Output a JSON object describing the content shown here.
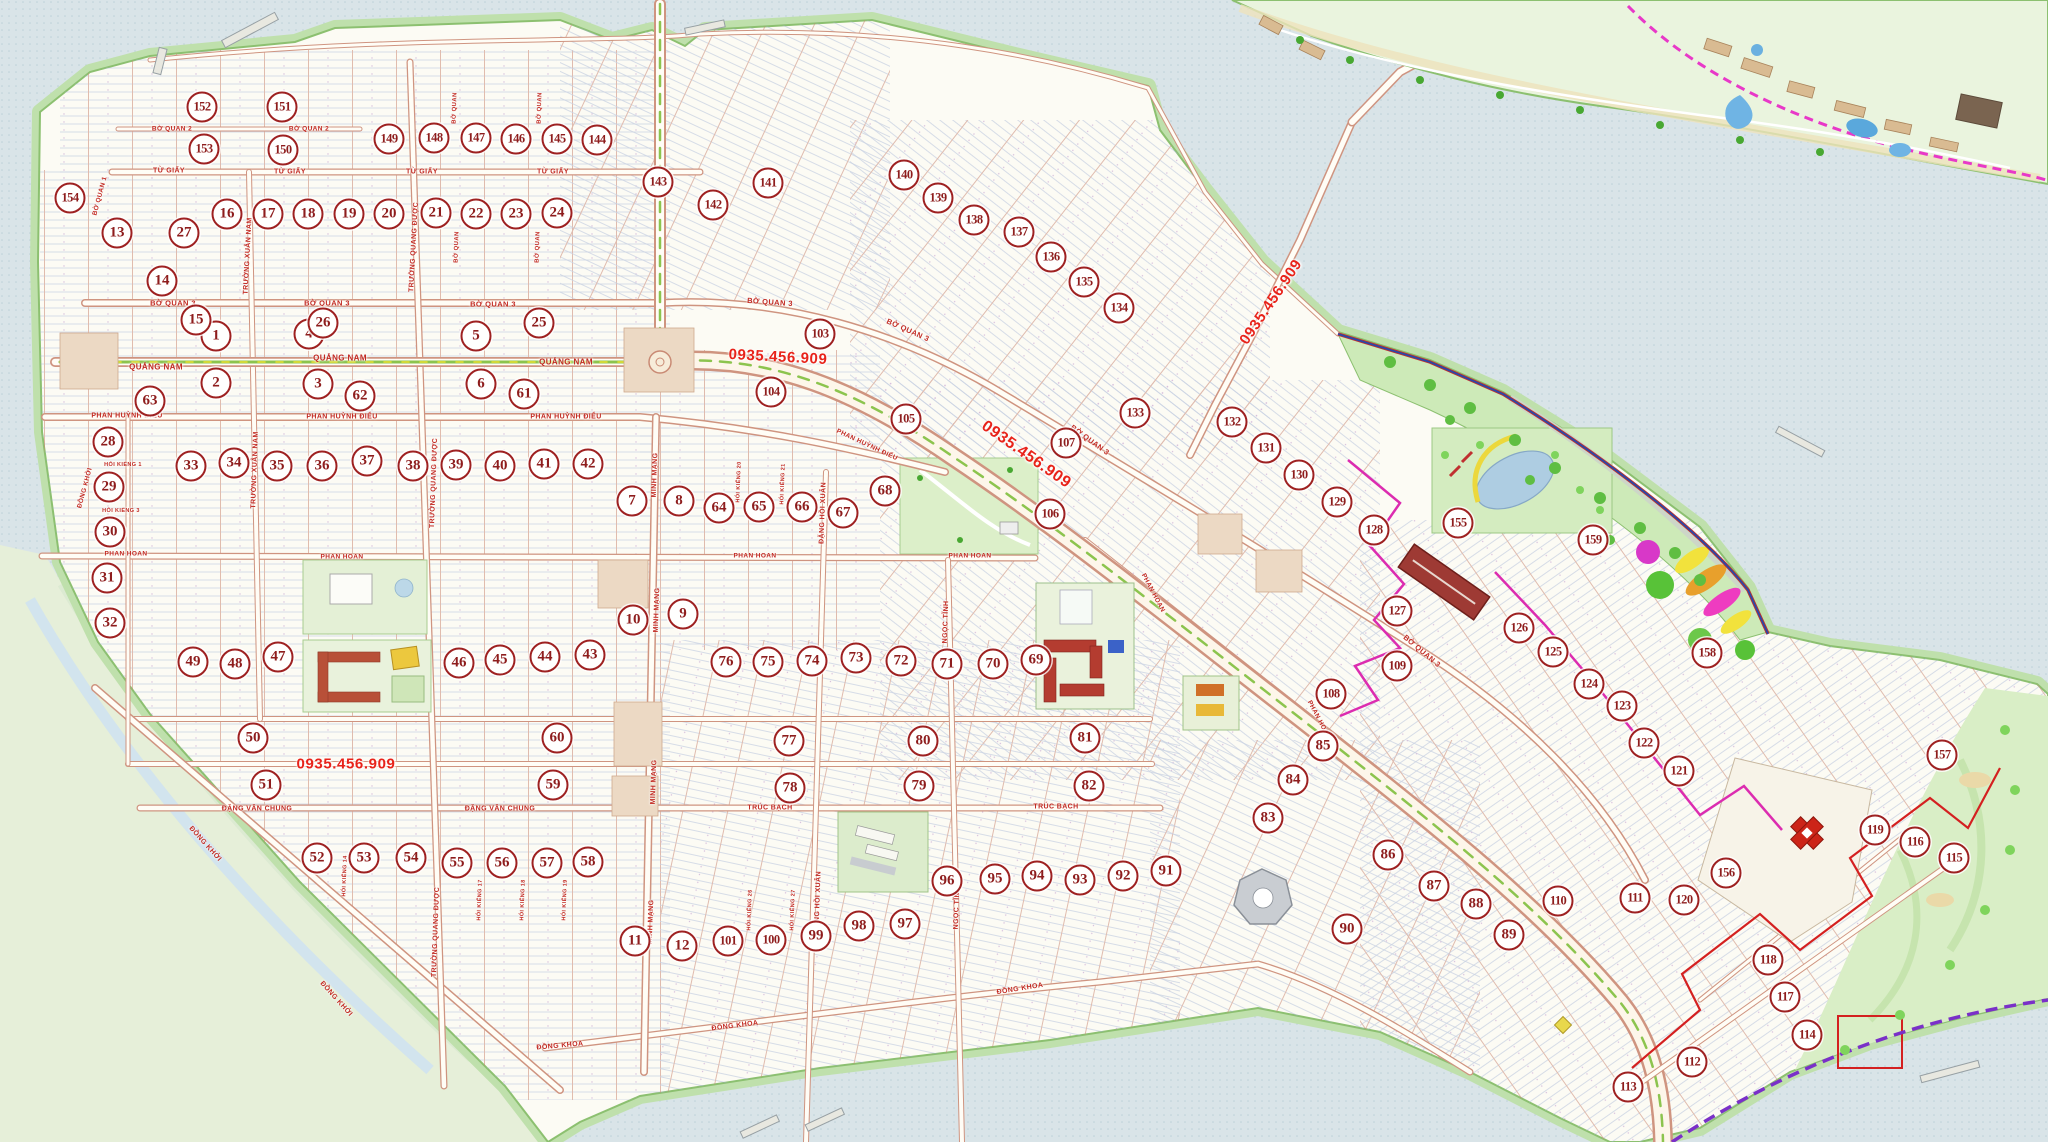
{
  "map_type": "real-estate subdivision master plan",
  "phone_number": "0935.456.909",
  "phone_labels": [
    {
      "text": "0935.456.909",
      "x": 778,
      "y": 357,
      "rot": 3,
      "size": 15
    },
    {
      "text": "0935.456.909",
      "x": 1026,
      "y": 455,
      "rot": 35,
      "size": 16
    },
    {
      "text": "0935.456.909",
      "x": 1271,
      "y": 302,
      "rot": -56,
      "size": 15
    },
    {
      "text": "0935.456.909",
      "x": 346,
      "y": 764,
      "rot": 0,
      "size": 15
    }
  ],
  "street_labels": [
    [
      "TỪ GIẤY",
      169,
      171,
      0,
      7
    ],
    [
      "TỪ GIẤY",
      290,
      172,
      0,
      7
    ],
    [
      "TỪ GIẤY",
      422,
      172,
      0,
      7
    ],
    [
      "TỪ GIẤY",
      553,
      172,
      0,
      7
    ],
    [
      "BỜ QUAN 2",
      172,
      129,
      0,
      6.5
    ],
    [
      "BỜ QUAN 2",
      309,
      129,
      0,
      6.5
    ],
    [
      "BỜ QUAN 1",
      100,
      196,
      -75,
      6.5
    ],
    [
      "BỜ QUAN",
      455,
      108,
      -88,
      6
    ],
    [
      "BỜ QUAN",
      540,
      108,
      -88,
      6
    ],
    [
      "BỜ QUAN",
      457,
      247,
      -88,
      6
    ],
    [
      "BỜ QUAN",
      538,
      247,
      -88,
      6
    ],
    [
      "BỜ QUAN 3",
      173,
      303,
      0,
      7.5
    ],
    [
      "BỜ QUAN 3",
      327,
      303,
      0,
      7.5
    ],
    [
      "BỜ QUAN 3",
      493,
      304,
      0,
      7.5
    ],
    [
      "BỜ QUAN 3",
      770,
      302,
      4,
      7.5
    ],
    [
      "BỜ QUAN 3",
      908,
      330,
      24,
      7.5
    ],
    [
      "BỜ QUAN 3",
      1090,
      440,
      36,
      7.5
    ],
    [
      "BỜ QUAN 3",
      1422,
      651,
      40,
      7.5
    ],
    [
      "QUẢNG NAM",
      156,
      367,
      0,
      8
    ],
    [
      "QUẢNG NAM",
      340,
      358,
      0,
      8
    ],
    [
      "QUẢNG NAM",
      566,
      362,
      0,
      8
    ],
    [
      "PHAN HUỲNH ĐIỂU",
      127,
      416,
      0,
      7
    ],
    [
      "PHAN HUỲNH ĐIỂU",
      342,
      417,
      0,
      7
    ],
    [
      "PHAN HUỲNH ĐIỂU",
      566,
      417,
      0,
      7
    ],
    [
      "PHAN HUỲNH ĐIỂU",
      867,
      445,
      25,
      6.5
    ],
    [
      "PHAN HOAN",
      126,
      554,
      0,
      6.5
    ],
    [
      "PHAN HOAN",
      342,
      557,
      0,
      6.5
    ],
    [
      "PHAN HOAN",
      755,
      556,
      0,
      6.5
    ],
    [
      "PHAN HOAN",
      970,
      556,
      0,
      6.5
    ],
    [
      "PHAN HOAN",
      1153,
      593,
      62,
      6.5
    ],
    [
      "PHAN HOAN",
      1319,
      720,
      62,
      6.5
    ],
    [
      "TRÚC BẠCH",
      770,
      808,
      0,
      7
    ],
    [
      "TRÚC BẠCH",
      1056,
      807,
      0,
      7
    ],
    [
      "ĐẶNG VĂN CHUNG",
      257,
      809,
      0,
      7
    ],
    [
      "ĐẶNG VĂN CHUNG",
      500,
      809,
      0,
      7
    ],
    [
      "ĐỒNG KHOA",
      560,
      1046,
      -5,
      7
    ],
    [
      "ĐỒNG KHOA",
      735,
      1026,
      -7,
      7
    ],
    [
      "ĐỒNG KHOA",
      1020,
      989,
      -9,
      7
    ],
    [
      "ĐỒNG KHỞI",
      205,
      844,
      48,
      7
    ],
    [
      "ĐỒNG KHỞI",
      336,
      999,
      48,
      7
    ],
    [
      "ĐỒNG KHỞI",
      85,
      488,
      -75,
      6.5
    ],
    [
      "MINH MẠNG",
      655,
      475,
      -88,
      7
    ],
    [
      "MINH MẠNG",
      657,
      610,
      -88,
      7
    ],
    [
      "MINH MẠNG",
      654,
      782,
      -88,
      7
    ],
    [
      "MINH MẠNG",
      651,
      922,
      -88,
      7
    ],
    [
      "TRƯỜNG XUÂN NAM",
      248,
      256,
      -87,
      7
    ],
    [
      "TRƯỜNG XUÂN NAM",
      255,
      470,
      -88,
      7
    ],
    [
      "TRƯỜNG QUANG ĐƯỢC",
      414,
      247,
      -87,
      7
    ],
    [
      "TRƯỜNG QUANG ĐƯỢC",
      434,
      483,
      -88,
      7
    ],
    [
      "TRƯỜNG QUANG ĐƯỢC",
      436,
      932,
      -88,
      7
    ],
    [
      "ĐẶNG HỒI XUÂN",
      823,
      513,
      -88,
      7
    ],
    [
      "ĐẶNG HỒI XUÂN",
      818,
      902,
      -88,
      7
    ],
    [
      "NGỌC TĨNH",
      946,
      622,
      -88,
      7
    ],
    [
      "NGỌC TĨNH",
      957,
      908,
      -88,
      7
    ],
    [
      "HÓI KIỂNG 1",
      123,
      465,
      0,
      5.5
    ],
    [
      "HÓI KIỂNG 3",
      121,
      511,
      0,
      5.5
    ],
    [
      "HÓI KIỂNG 20",
      739,
      482,
      -88,
      5.5
    ],
    [
      "HÓI KIỂNG 21",
      783,
      484,
      -88,
      5.5
    ],
    [
      "HÓI KIỂNG 14",
      345,
      876,
      -88,
      5.5
    ],
    [
      "HÓI KIỂNG 17",
      480,
      900,
      -88,
      5.5
    ],
    [
      "HÓI KIỂNG 18",
      523,
      900,
      -88,
      5.5
    ],
    [
      "HÓI KIỂNG 19",
      565,
      900,
      -88,
      5.5
    ],
    [
      "HÓI KIỂNG 26",
      750,
      910,
      -88,
      5.5
    ],
    [
      "HÓI KIỂNG 27",
      793,
      910,
      -88,
      5.5
    ]
  ],
  "blocks": [
    [
      1,
      216,
      336
    ],
    [
      2,
      216,
      383
    ],
    [
      3,
      318,
      384
    ],
    [
      4,
      309,
      334
    ],
    [
      5,
      476,
      336
    ],
    [
      6,
      481,
      384
    ],
    [
      7,
      632,
      501
    ],
    [
      8,
      679,
      501
    ],
    [
      9,
      683,
      614
    ],
    [
      10,
      633,
      620
    ],
    [
      11,
      635,
      941
    ],
    [
      12,
      682,
      946
    ],
    [
      13,
      117,
      233
    ],
    [
      14,
      162,
      281
    ],
    [
      15,
      196,
      320
    ],
    [
      16,
      227,
      214
    ],
    [
      17,
      268,
      214
    ],
    [
      18,
      308,
      214
    ],
    [
      19,
      349,
      214
    ],
    [
      20,
      389,
      214
    ],
    [
      21,
      436,
      213
    ],
    [
      22,
      476,
      214
    ],
    [
      23,
      516,
      214
    ],
    [
      24,
      557,
      213
    ],
    [
      25,
      539,
      323
    ],
    [
      26,
      323,
      323
    ],
    [
      27,
      184,
      233
    ],
    [
      28,
      108,
      442
    ],
    [
      29,
      109,
      487
    ],
    [
      30,
      110,
      532
    ],
    [
      31,
      107,
      578
    ],
    [
      32,
      110,
      623
    ],
    [
      33,
      191,
      466
    ],
    [
      34,
      234,
      463
    ],
    [
      35,
      277,
      466
    ],
    [
      36,
      322,
      466
    ],
    [
      37,
      367,
      461
    ],
    [
      38,
      413,
      466
    ],
    [
      39,
      456,
      465
    ],
    [
      40,
      500,
      466
    ],
    [
      41,
      544,
      464
    ],
    [
      42,
      588,
      464
    ],
    [
      43,
      590,
      655
    ],
    [
      44,
      545,
      657
    ],
    [
      45,
      500,
      660
    ],
    [
      46,
      459,
      663
    ],
    [
      47,
      278,
      657
    ],
    [
      48,
      235,
      664
    ],
    [
      49,
      193,
      662
    ],
    [
      50,
      253,
      738
    ],
    [
      51,
      266,
      785
    ],
    [
      52,
      317,
      858
    ],
    [
      53,
      364,
      858
    ],
    [
      54,
      411,
      858
    ],
    [
      55,
      457,
      863
    ],
    [
      56,
      502,
      863
    ],
    [
      57,
      547,
      863
    ],
    [
      58,
      588,
      862
    ],
    [
      59,
      553,
      785
    ],
    [
      60,
      557,
      738
    ],
    [
      61,
      524,
      394
    ],
    [
      62,
      360,
      396
    ],
    [
      63,
      150,
      401
    ],
    [
      64,
      719,
      508
    ],
    [
      65,
      759,
      507
    ],
    [
      66,
      802,
      507
    ],
    [
      67,
      843,
      513
    ],
    [
      68,
      885,
      491
    ],
    [
      69,
      1036,
      660
    ],
    [
      70,
      993,
      664
    ],
    [
      71,
      947,
      664
    ],
    [
      72,
      901,
      661
    ],
    [
      73,
      856,
      658
    ],
    [
      74,
      812,
      661
    ],
    [
      75,
      768,
      662
    ],
    [
      76,
      726,
      662
    ],
    [
      77,
      789,
      741
    ],
    [
      78,
      790,
      788
    ],
    [
      79,
      919,
      786
    ],
    [
      80,
      923,
      741
    ],
    [
      81,
      1085,
      738
    ],
    [
      82,
      1089,
      786
    ],
    [
      83,
      1268,
      818
    ],
    [
      84,
      1293,
      780
    ],
    [
      85,
      1323,
      746
    ],
    [
      86,
      1388,
      855
    ],
    [
      87,
      1434,
      886
    ],
    [
      88,
      1476,
      904
    ],
    [
      89,
      1509,
      935
    ],
    [
      90,
      1347,
      929
    ],
    [
      91,
      1166,
      871
    ],
    [
      92,
      1123,
      876
    ],
    [
      93,
      1080,
      880
    ],
    [
      94,
      1037,
      876
    ],
    [
      95,
      995,
      879
    ],
    [
      96,
      947,
      881
    ],
    [
      97,
      905,
      924
    ],
    [
      98,
      859,
      926
    ],
    [
      99,
      816,
      936
    ],
    [
      100,
      771,
      940
    ],
    [
      101,
      728,
      941
    ],
    [
      103,
      820,
      334
    ],
    [
      104,
      771,
      392
    ],
    [
      105,
      906,
      419
    ],
    [
      106,
      1050,
      514
    ],
    [
      107,
      1066,
      443
    ],
    [
      108,
      1331,
      694
    ],
    [
      109,
      1397,
      666
    ],
    [
      110,
      1558,
      901
    ],
    [
      111,
      1635,
      898
    ],
    [
      112,
      1692,
      1062
    ],
    [
      113,
      1628,
      1087
    ],
    [
      114,
      1807,
      1035
    ],
    [
      115,
      1954,
      858
    ],
    [
      116,
      1915,
      842
    ],
    [
      117,
      1785,
      997
    ],
    [
      118,
      1768,
      960
    ],
    [
      119,
      1875,
      830
    ],
    [
      120,
      1684,
      900
    ],
    [
      121,
      1679,
      771
    ],
    [
      122,
      1644,
      743
    ],
    [
      123,
      1622,
      706
    ],
    [
      124,
      1589,
      684
    ],
    [
      125,
      1553,
      652
    ],
    [
      126,
      1519,
      628
    ],
    [
      127,
      1397,
      611
    ],
    [
      128,
      1374,
      530
    ],
    [
      129,
      1337,
      502
    ],
    [
      130,
      1299,
      475
    ],
    [
      131,
      1266,
      448
    ],
    [
      132,
      1232,
      422
    ],
    [
      133,
      1135,
      413
    ],
    [
      134,
      1119,
      308
    ],
    [
      135,
      1084,
      282
    ],
    [
      136,
      1051,
      257
    ],
    [
      137,
      1019,
      232
    ],
    [
      138,
      974,
      220
    ],
    [
      139,
      938,
      198
    ],
    [
      140,
      904,
      175
    ],
    [
      141,
      768,
      183
    ],
    [
      142,
      713,
      205
    ],
    [
      143,
      658,
      182
    ],
    [
      144,
      597,
      140
    ],
    [
      145,
      557,
      139
    ],
    [
      146,
      516,
      139
    ],
    [
      147,
      476,
      138
    ],
    [
      148,
      434,
      138
    ],
    [
      149,
      389,
      139
    ],
    [
      150,
      283,
      150
    ],
    [
      151,
      282,
      107
    ],
    [
      152,
      202,
      107
    ],
    [
      153,
      204,
      149
    ],
    [
      154,
      70,
      198
    ],
    [
      155,
      1458,
      523
    ],
    [
      156,
      1726,
      873
    ],
    [
      157,
      1942,
      755
    ],
    [
      158,
      1707,
      653
    ],
    [
      159,
      1593,
      540
    ]
  ],
  "colors": {
    "water": "#d9e4e8",
    "land": "#fcfbf4",
    "green_fringe": "#bfe0ac",
    "park": "#cdeab8",
    "road_fill": "#fffdf6",
    "road_casing": "#cf9480",
    "marker_ring": "#9e2121",
    "marker_text": "#8e1d1d",
    "street_text": "#c22a22",
    "phone_red": "#e8231a",
    "median_green": "#8cc44e",
    "boundary_magenta": "#dc2cb0",
    "boundary_red": "#d42020",
    "shore_purple": "#7a30c8",
    "resort_dash": "#e838c8",
    "building_red": "#b43c30",
    "mall_red": "#9e3a34",
    "pool_blue": "#3b62c8",
    "lake_blue": "#aecde2"
  }
}
